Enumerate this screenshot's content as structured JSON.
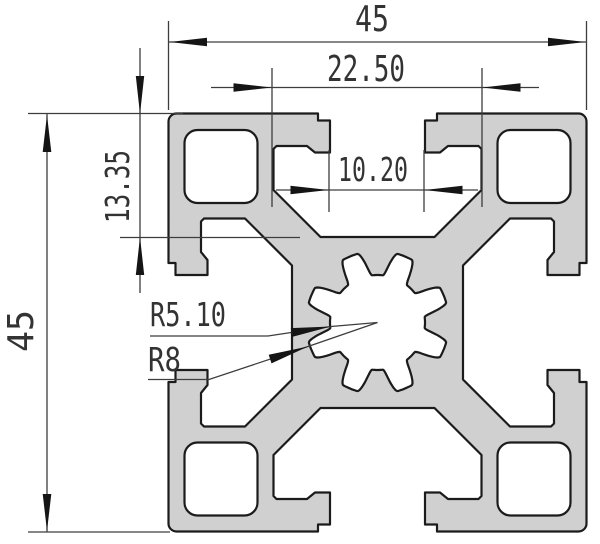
{
  "drawing": {
    "title": "45x45 aluminium extrusion profile cross-section",
    "dims": {
      "width_top": "45",
      "slot_cavity_width": "22.50",
      "slot_opening_width": "10.20",
      "slot_depth": "13.35",
      "height_left": "45",
      "center_bore_radius": "R5.10",
      "serration_radius": "R8"
    }
  },
  "colors": {
    "background": "#ffffff",
    "profile_fill": "#d0d0d0",
    "outline": "#1b1b1b",
    "dimension_lines": "#3d3d3d",
    "text": "#333333"
  }
}
